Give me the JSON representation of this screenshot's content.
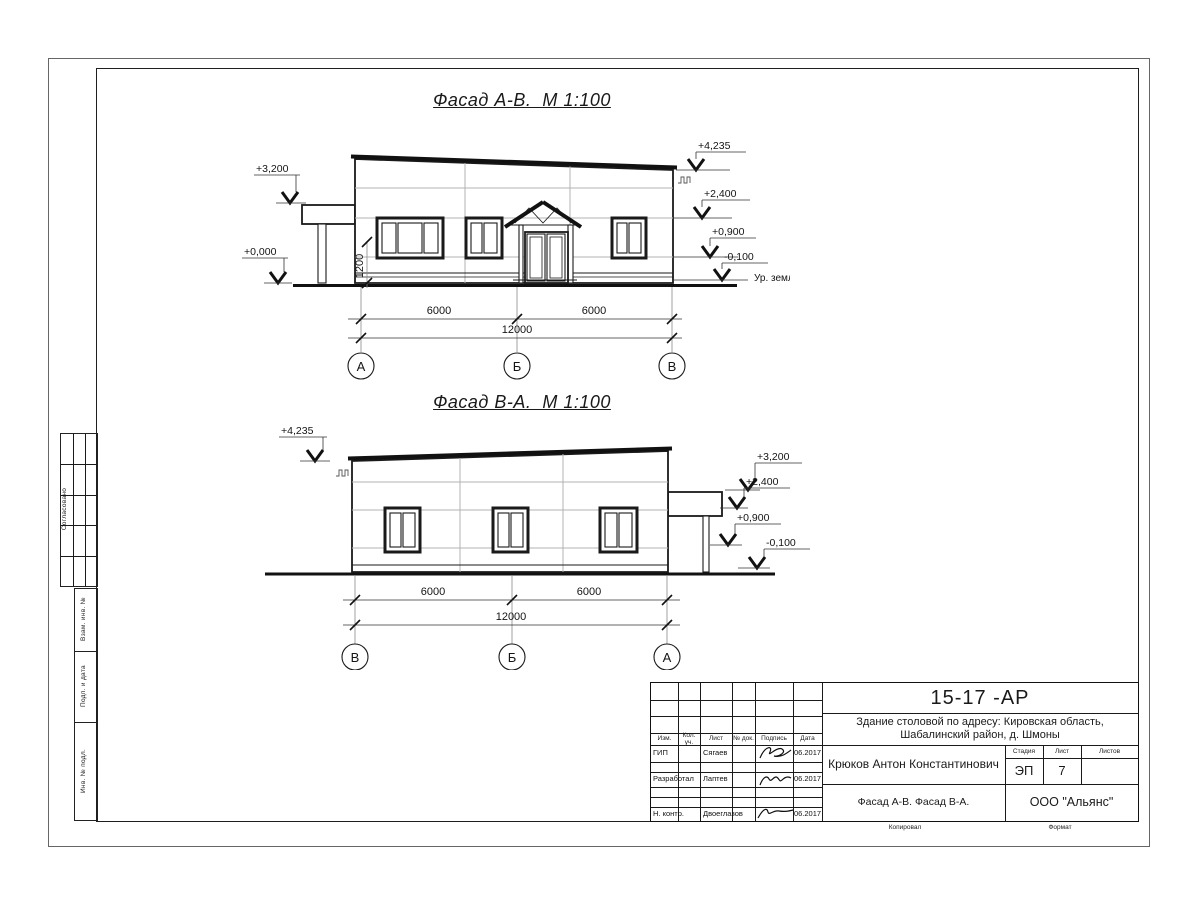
{
  "facade1": {
    "title": "Фасад А-В.  М 1:100",
    "marks": {
      "zero": "+0,000",
      "canopy": "+3,200",
      "top": "+4,235",
      "lintel": "+2,400",
      "sill": "+0,900",
      "ground": "-0,100",
      "ground_label": "Ур. земли"
    },
    "dim_sill": "1200",
    "dims": {
      "left": "6000",
      "right": "6000",
      "total": "12000"
    },
    "axes": [
      "А",
      "Б",
      "В"
    ]
  },
  "facade2": {
    "title": "Фасад В-А.  М 1:100",
    "marks": {
      "top": "+4,235",
      "canopy": "+3,200",
      "lintel": "+2,400",
      "sill": "+0,900",
      "ground": "-0,100"
    },
    "dims": {
      "left": "6000",
      "right": "6000",
      "total": "12000"
    },
    "axes": [
      "В",
      "Б",
      "А"
    ]
  },
  "margin": {
    "approved": "Согласовано",
    "replace_inv": "Взам. инв. №",
    "sign_date": "Подп. и дата",
    "inv_orig": "Инв. № подл."
  },
  "stamp": {
    "doc_number": "15-17 -АР",
    "project_line1": "Здание столовой по адресу: Кировская область,",
    "project_line2": "Шабалинский район, д. Шмоны",
    "header": {
      "izm": "Изм.",
      "kol_uch": "Кол. уч.",
      "list": "Лист",
      "n_dok": "№ док.",
      "podpis": "Подпись",
      "data": "Дата"
    },
    "rows": [
      {
        "role": "ГИП",
        "name": "Сягаев",
        "date": "06.2017"
      },
      {
        "role": "Разработал",
        "name": "Лаптев",
        "date": "06.2017"
      },
      {
        "role": "Н. контр.",
        "name": "Двоеглазов",
        "date": "06.2017"
      }
    ],
    "client": "Крюков Антон Константинович",
    "stage_label": "Стадия",
    "sheet_label": "Лист",
    "sheets_label": "Листов",
    "stage": "ЭП",
    "sheet_number": "7",
    "sheets_total": "",
    "sheet_title": "Фасад А-В. Фасад В-А.",
    "company": "ООО \"Альянс\""
  },
  "footer": {
    "copied": "Копировал",
    "format": "Формат"
  }
}
